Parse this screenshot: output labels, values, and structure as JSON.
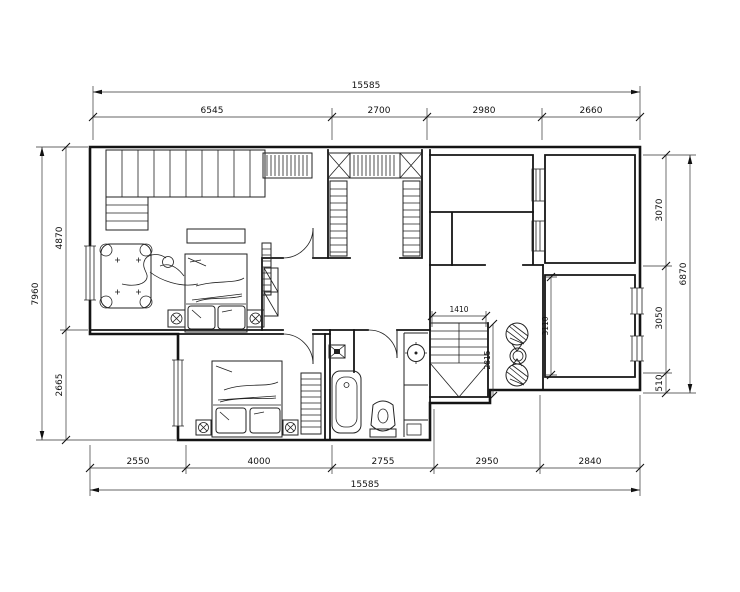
{
  "drawing": {
    "type": "architectural-floor-plan",
    "colors": {
      "line": "#141414",
      "dimension": "#333333",
      "background": "#ffffff"
    }
  },
  "dims": {
    "top_total": "15585",
    "top_segments": [
      "6545",
      "2700",
      "2980",
      "2660"
    ],
    "bottom_segments": [
      "2550",
      "4000",
      "2755",
      "2950",
      "2840"
    ],
    "bottom_total": "15585",
    "left_total": "7960",
    "left_segments": [
      "4870",
      "2665"
    ],
    "right_segments": [
      "3070",
      "3050",
      "510"
    ],
    "right_total": "6870",
    "stair_width": "1410",
    "stair_depth": "2815",
    "room_depth": "3110"
  }
}
